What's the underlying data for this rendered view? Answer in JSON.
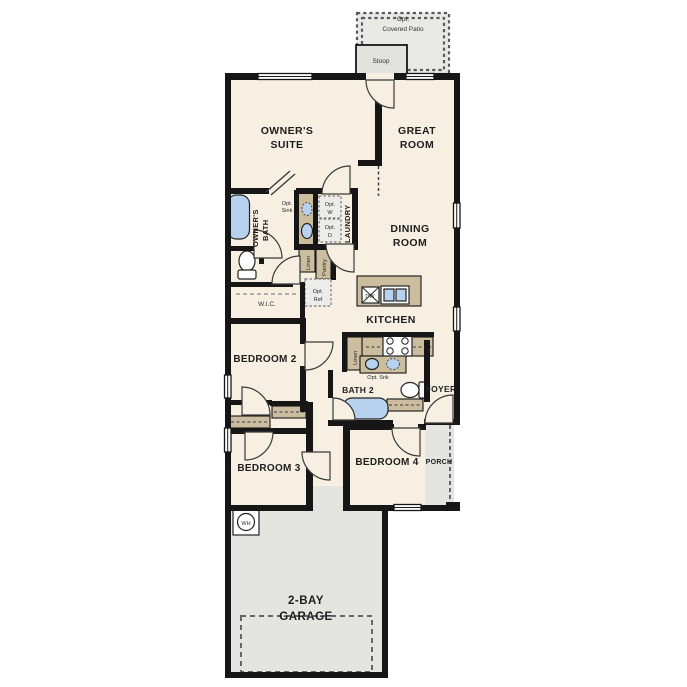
{
  "colors": {
    "floor": "#f7efe2",
    "concrete": "#e4e4e1",
    "patio": "#e9e9e6",
    "wall": "#161616",
    "casework": "#cbbd9e",
    "fixture_blue": "#b7d2ee",
    "label": "#1e1e1e"
  },
  "labels": {
    "patio_l1": "Opt.",
    "patio_l2": "Covered Patio",
    "stoop": "Stoop",
    "owners_suite_l1": "OWNER'S",
    "owners_suite_l2": "SUITE",
    "great_room_l1": "GREAT",
    "great_room_l2": "ROOM",
    "owners_bath_l1": "OWNER'S",
    "owners_bath_l2": "BATH",
    "opt_sink_l1": "Opt.",
    "opt_sink_l2": "Sink",
    "laundry": "LAUNDRY",
    "opt_w_l1": "Opt.",
    "opt_w_l2": "W",
    "opt_d_l1": "Opt.",
    "opt_d_l2": "D",
    "linen_hall": "Linen",
    "pantry": "Pantry",
    "opt_ref_l1": "Opt.",
    "opt_ref_l2": "Ref",
    "wic": "W.I.C.",
    "dining_l1": "DINING",
    "dining_l2": "ROOM",
    "kitchen": "KITCHEN",
    "dw": "DW",
    "bedroom2": "BEDROOM 2",
    "linen_kitchen": "Linen",
    "opt_snk": "Opt. Snk",
    "bath2": "BATH 2",
    "foyer": "FOYER",
    "bedroom3": "BEDROOM 3",
    "bedroom4": "BEDROOM 4",
    "porch": "PORCH",
    "wh": "WH",
    "garage_l1": "2-BAY",
    "garage_l2": "GARAGE"
  }
}
